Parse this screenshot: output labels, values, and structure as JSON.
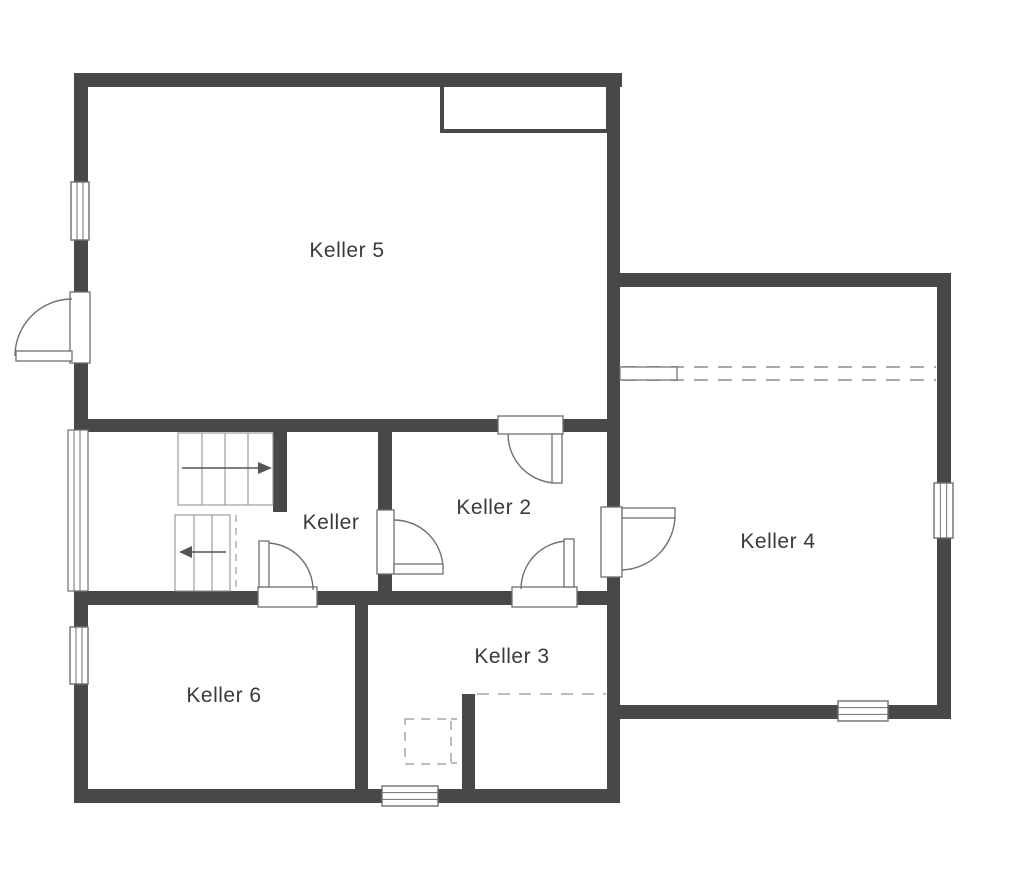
{
  "title": "Keller Grundriss (basement floor plan)",
  "colors": {
    "wall": "#484848",
    "thin_line": "#6f6f6f",
    "stair_line": "#8a8a8a",
    "dash_line": "#a9a9a9",
    "text": "#3a3a3a",
    "background": "#ffffff"
  },
  "rooms": [
    {
      "id": "keller-5",
      "label": "Keller 5",
      "cx": 347,
      "cy": 251
    },
    {
      "id": "keller",
      "label": "Keller",
      "cx": 331,
      "cy": 523
    },
    {
      "id": "keller-2",
      "label": "Keller 2",
      "cx": 494,
      "cy": 508
    },
    {
      "id": "keller-4",
      "label": "Keller 4",
      "cx": 778,
      "cy": 542
    },
    {
      "id": "keller-3",
      "label": "Keller 3",
      "cx": 512,
      "cy": 657
    },
    {
      "id": "keller-6",
      "label": "Keller 6",
      "cx": 224,
      "cy": 696
    }
  ],
  "plan": {
    "width": 1024,
    "height": 878,
    "walls": [
      {
        "id": "top-wall",
        "x": 74,
        "y": 73,
        "w": 548,
        "h": 14
      },
      {
        "id": "left-wall-a",
        "x": 74,
        "y": 87,
        "w": 14,
        "h": 95
      },
      {
        "id": "left-wall-b",
        "x": 74,
        "y": 240,
        "w": 14,
        "h": 52
      },
      {
        "id": "left-wall-c",
        "x": 74,
        "y": 363,
        "w": 14,
        "h": 67
      },
      {
        "id": "left-wall-d",
        "x": 74,
        "y": 591,
        "w": 14,
        "h": 36
      },
      {
        "id": "left-wall-e",
        "x": 74,
        "y": 684,
        "w": 14,
        "h": 119
      },
      {
        "id": "bottom-wall-left",
        "x": 74,
        "y": 789,
        "w": 546,
        "h": 14
      },
      {
        "id": "right-spine-wall",
        "x": 607,
        "y": 73,
        "w": 13,
        "h": 730
      },
      {
        "id": "keller5-bottom-wall",
        "x": 74,
        "y": 419,
        "w": 546,
        "h": 13
      },
      {
        "id": "hall-keller-divider",
        "x": 273,
        "y": 432,
        "w": 14,
        "h": 80
      },
      {
        "id": "keller-keller2-divider",
        "x": 378,
        "y": 432,
        "w": 14,
        "h": 161
      },
      {
        "id": "hall-bottom-wall",
        "x": 74,
        "y": 591,
        "w": 546,
        "h": 14
      },
      {
        "id": "keller6-keller3-divider",
        "x": 355,
        "y": 605,
        "w": 13,
        "h": 184
      },
      {
        "id": "keller3-stub-wall",
        "x": 462,
        "y": 694,
        "w": 13,
        "h": 95
      },
      {
        "id": "keller4-top-wall",
        "x": 620,
        "y": 273,
        "w": 331,
        "h": 14
      },
      {
        "id": "keller4-right-wall",
        "x": 937,
        "y": 273,
        "w": 14,
        "h": 446
      },
      {
        "id": "keller4-bottom-wall",
        "x": 607,
        "y": 705,
        "w": 344,
        "h": 14
      }
    ],
    "chimney": {
      "x": 442,
      "y": 85,
      "w": 166,
      "h": 46
    },
    "windows": [
      {
        "id": "window-keller5-left",
        "x": 71,
        "y": 182,
        "w": 18,
        "h": 58,
        "dir": "v"
      },
      {
        "id": "window-keller6-left",
        "x": 70,
        "y": 627,
        "w": 18,
        "h": 57,
        "dir": "v"
      },
      {
        "id": "window-keller3-bottom",
        "x": 382,
        "y": 786,
        "w": 56,
        "h": 20,
        "dir": "h"
      },
      {
        "id": "window-keller4-bottom",
        "x": 838,
        "y": 701,
        "w": 50,
        "h": 20,
        "dir": "h"
      },
      {
        "id": "window-keller4-right",
        "x": 934,
        "y": 483,
        "w": 19,
        "h": 55,
        "dir": "v"
      }
    ],
    "glazing_band": {
      "id": "stair-window-band",
      "x": 68,
      "y": 430,
      "w": 20,
      "h": 161,
      "inner_x": [
        74,
        80
      ]
    },
    "doors": [
      {
        "id": "door-entrance-left",
        "jamb": {
          "x": 70,
          "y": 292,
          "w": 20,
          "h": 71
        },
        "leaf": {
          "x": 16,
          "y": 351,
          "w": 56,
          "h": 10
        },
        "arc": "M72,299 A57,57 0 0 0 15,356"
      },
      {
        "id": "door-keller5-keller2",
        "jamb": {
          "x": 498,
          "y": 416,
          "w": 65,
          "h": 18
        },
        "leaf": {
          "x": 552,
          "y": 434,
          "w": 10,
          "h": 49
        },
        "arc": "M557,483 A49,49 0 0 1 508,434"
      },
      {
        "id": "door-keller-keller2",
        "jamb": {
          "x": 377,
          "y": 510,
          "w": 17,
          "h": 64
        },
        "leaf": {
          "x": 394,
          "y": 564,
          "w": 49,
          "h": 10
        },
        "arc": "M394,520 A49,49 0 0 1 443,569"
      },
      {
        "id": "door-keller2-keller4",
        "jamb": {
          "x": 601,
          "y": 507,
          "w": 21,
          "h": 70
        },
        "leaf": {
          "x": 622,
          "y": 508,
          "w": 53,
          "h": 10
        },
        "arc": "M675,516 A55,55 0 0 1 622,570"
      },
      {
        "id": "door-keller2-keller3",
        "jamb": {
          "x": 512,
          "y": 587,
          "w": 65,
          "h": 20
        },
        "leaf": {
          "x": 564,
          "y": 539,
          "w": 10,
          "h": 48
        },
        "arc": "M568,541 A48,48 0 0 0 521,589"
      },
      {
        "id": "door-hall-keller6",
        "jamb": {
          "x": 258,
          "y": 587,
          "w": 59,
          "h": 20
        },
        "leaf": {
          "x": 259,
          "y": 541,
          "w": 10,
          "h": 46
        },
        "arc": "M267,543 A47,47 0 0 1 313,590"
      }
    ],
    "stairs": {
      "upper_flight": {
        "x": 178,
        "y": 433,
        "w": 95,
        "h": 72,
        "treads_x": [
          202,
          225,
          248
        ],
        "arrow": {
          "x1": 182,
          "y": 468,
          "x2": 260,
          "head": [
            [
              258,
              462
            ],
            [
              272,
              468
            ],
            [
              258,
              474
            ]
          ]
        }
      },
      "lower_flight": {
        "x": 175,
        "y": 515,
        "w": 55,
        "h": 76,
        "treads_x": [
          194,
          212
        ],
        "arrow": {
          "x1": 226,
          "y": 552,
          "x2": 192,
          "head": [
            [
              192,
              546
            ],
            [
              179,
              552
            ],
            [
              192,
              558
            ]
          ]
        }
      },
      "cut_dash_line": {
        "x1": 236,
        "y1": 515,
        "x2": 236,
        "y2": 591
      }
    },
    "dashed": {
      "keller4_band": {
        "x1": 622,
        "y1": 367,
        "x2": 936,
        "y2": 380,
        "solid_rect": {
          "x": 620,
          "y": 367,
          "w": 57,
          "h": 13
        }
      },
      "keller3_line": {
        "x1": 477,
        "y1": 694,
        "x2": 606,
        "y2": 694
      },
      "keller3_rect": {
        "x": 405,
        "y": 719,
        "w": 46,
        "h": 45
      },
      "keller3_conn_top": {
        "x1": 451,
        "y1": 719,
        "x2": 462,
        "y2": 719
      },
      "keller3_conn_bottom": {
        "x1": 451,
        "y1": 763,
        "x2": 462,
        "y2": 763
      }
    }
  }
}
